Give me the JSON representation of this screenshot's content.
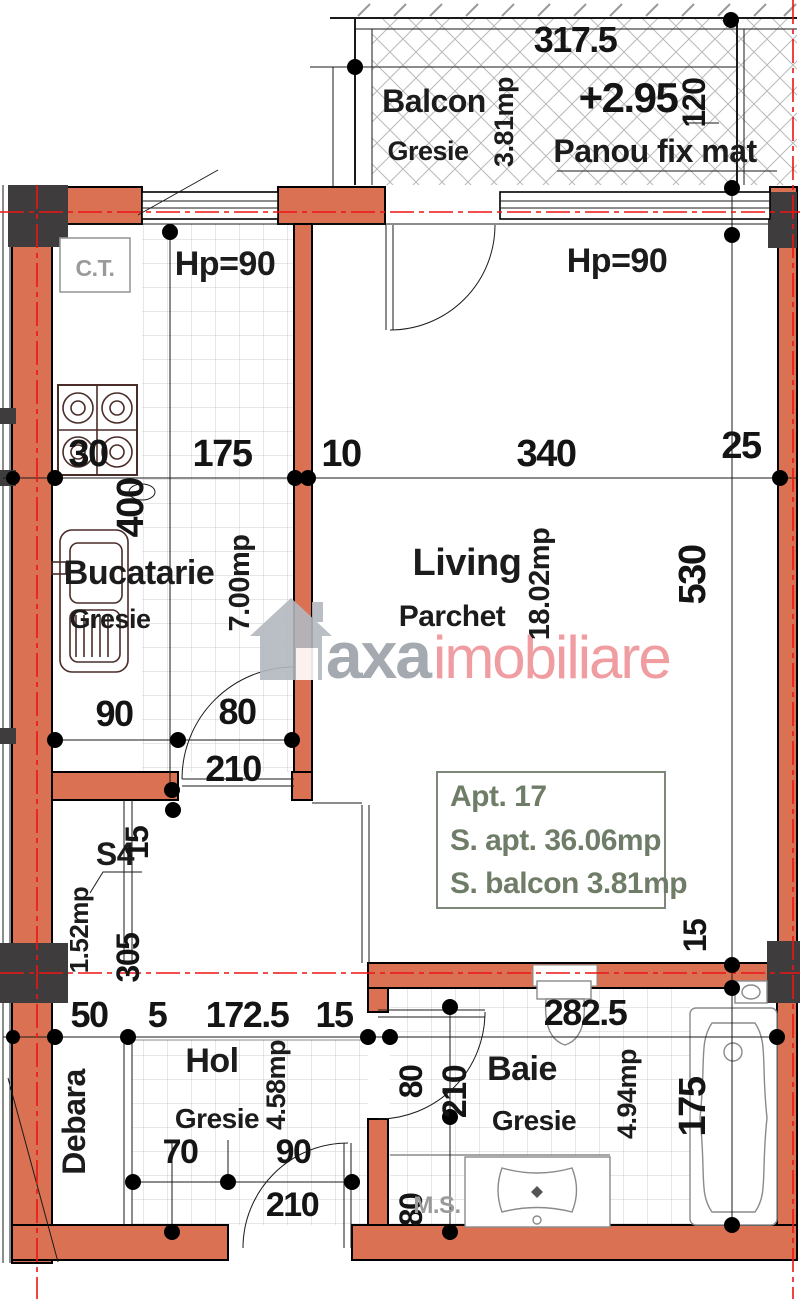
{
  "colors": {
    "wall": "#d97152",
    "column": "#3e3c3d",
    "axis": "#ee1414",
    "info": "#6f7d68",
    "accent": "#ef9398",
    "brand-gray": "#9ba1a8"
  },
  "balcony": {
    "name": "Balcon",
    "floor": "Gresie",
    "area": "3.81mp",
    "level": "+2.95",
    "panel": "Panou fix mat",
    "dim_width": "317.5",
    "dim_height": "120"
  },
  "kitchen": {
    "name": "Bucatarie",
    "floor": "Gresie",
    "area": "7.00mp",
    "boiler": "C.T.",
    "window": "Hp=90",
    "dims": {
      "seg30": "30",
      "seg175": "175",
      "seg10": "10",
      "height": "400",
      "front": "90",
      "door_w": "80",
      "door_h": "210"
    }
  },
  "living": {
    "name": "Living",
    "floor": "Parchet",
    "area": "18.02mp",
    "window": "Hp=90",
    "dims": {
      "seg340": "340",
      "seg25": "25",
      "height": "530",
      "wall15": "15"
    }
  },
  "shaft": {
    "name": "S4",
    "area": "1.52mp",
    "dims": {
      "wall15": "15",
      "seg305": "305"
    }
  },
  "hall": {
    "name": "Hol",
    "floor": "Gresie",
    "area": "4.58mp",
    "dims": {
      "seg70": "70",
      "door_w": "90",
      "door_h": "210"
    }
  },
  "storage": {
    "name": "Debara"
  },
  "bath": {
    "name": "Baie",
    "floor": "Gresie",
    "area": "4.94mp",
    "washer": "M.S.",
    "dims": {
      "door_w": "80",
      "door_h": "210",
      "niche": "80",
      "tub": "175"
    }
  },
  "bottom_dims": {
    "seg50": "50",
    "seg5": "5",
    "seg172": "172.5",
    "seg15": "15",
    "seg282": "282.5"
  },
  "info_box": {
    "line1": "Apt. 17",
    "line2": "S. apt. 36.06mp",
    "line3": "S. balcon 3.81mp"
  },
  "watermark": {
    "name_gray": "axa",
    "name_accent": "imobiliare"
  }
}
